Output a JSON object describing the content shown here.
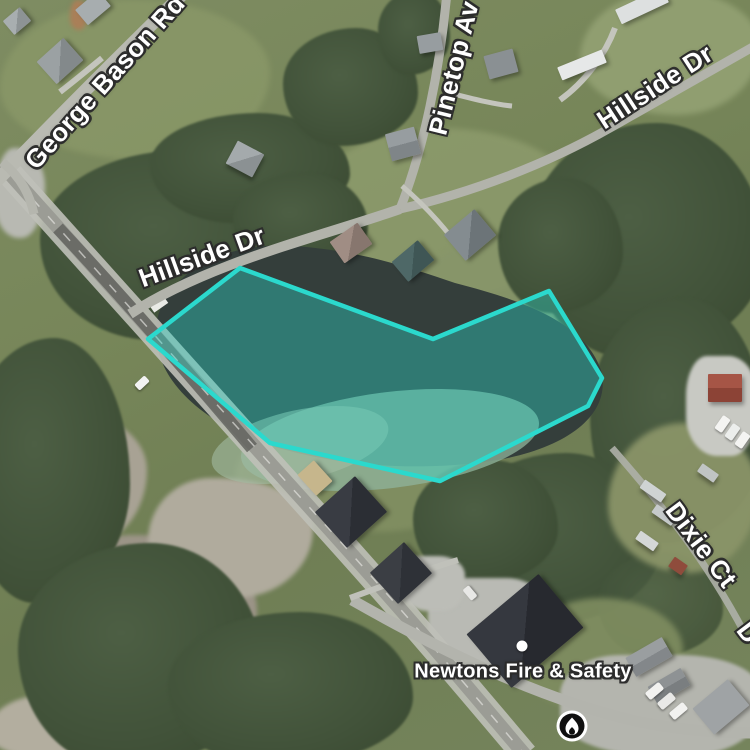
{
  "map": {
    "road_labels": [
      {
        "id": "george-bason-rd",
        "text": "George Bason Rd"
      },
      {
        "id": "pinetop-av",
        "text": "Pinetop Av"
      },
      {
        "id": "hillside-dr-northeast",
        "text": "Hillside Dr"
      },
      {
        "id": "hillside-dr-west",
        "text": "Hillside Dr"
      },
      {
        "id": "dixie-ct",
        "text": "Dixie Ct"
      },
      {
        "id": "partial-road-label",
        "text": "D"
      }
    ],
    "poi": {
      "label": "Newtons Fire & Safety",
      "icon": "fire-icon",
      "icon_background": "#101010",
      "icon_ring_color": "#ffffff",
      "icon_glyph_color": "#ffffff"
    },
    "highlight_polygon": {
      "points": "240,268 433,339 549,291 602,378 588,406 440,481 270,443 148,339",
      "stroke_color": "#2bd9cd",
      "fill_color": "rgba(43,217,205,0.38)",
      "stroke_width": "4.5"
    }
  }
}
